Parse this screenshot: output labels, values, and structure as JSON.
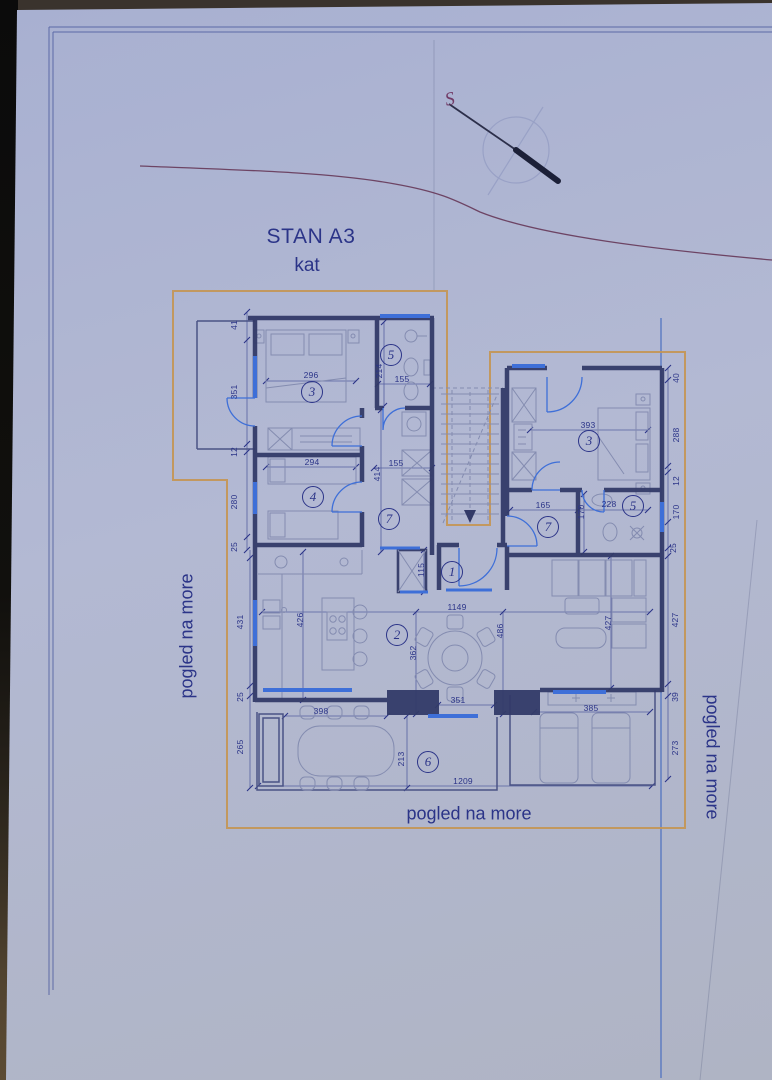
{
  "title": {
    "line1": "STAN A3",
    "line2": "kat"
  },
  "compass": {
    "label": "S"
  },
  "views": {
    "left": "pogled na more",
    "bottom": "pogled na more",
    "right": "pogled na more"
  },
  "rooms": [
    "3",
    "5",
    "4",
    "7",
    "3",
    "5",
    "7",
    "1",
    "2",
    "6"
  ],
  "dims": [
    "296",
    "155",
    "294",
    "155",
    "393",
    "165",
    "228",
    "1149",
    "398",
    "351",
    "1209",
    "385",
    "41",
    "351",
    "12",
    "280",
    "25",
    "431",
    "25",
    "265",
    "214",
    "414",
    "115",
    "426",
    "362",
    "486",
    "427",
    "213",
    "170",
    "40",
    "288",
    "12",
    "170",
    "25",
    "427",
    "39",
    "273"
  ],
  "colors": {
    "ink": "#2b3488",
    "wall": "#333a68",
    "furn": "#848cb0",
    "window": "#3e6fd8",
    "boundary": "#c49552",
    "contour": "#6d4464",
    "dimline": "#5560a0",
    "paperTop": "#a8b0d1",
    "paperMid": "#b3b9d3",
    "paperBot": "#afb4c4"
  }
}
